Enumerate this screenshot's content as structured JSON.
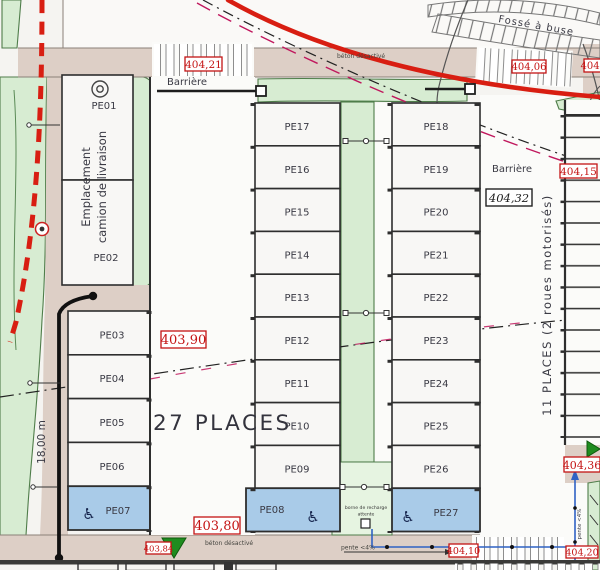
{
  "labels": {
    "places_27": "27 PLACES",
    "places_11": "11 PLACES (2 roues motorisés)",
    "barriere_left": "Barrière",
    "barriere_right": "Barrière",
    "emplacement_l1": "Emplacement",
    "emplacement_l2": "camion de livraison",
    "fosse": "Fossé à buse",
    "beton_top": "béton désactivé",
    "beton_bottom": "béton désactivé",
    "pente_bottom": "pente <4%",
    "pente_right": "pente <4%",
    "dim_left": "18,00 m",
    "borne_l1": "borne de recharge",
    "borne_l2": "attente"
  },
  "levels": {
    "crosswalk_top_left": "404,21",
    "crosswalk_top_right": "404,06",
    "top_right_edge": "404,41",
    "right_edge": "404,15",
    "platform_mid": "404,32",
    "aisle_upper": "403,90",
    "aisle_lower": "403,80",
    "bottom_left": "403,84",
    "bottom_pente": "404,10",
    "bottom_right": "404,20",
    "right_lower": "404,36"
  },
  "stalls": {
    "left_top": [
      "PE01",
      "PE02"
    ],
    "left": [
      "PE03",
      "PE04",
      "PE05",
      "PE06",
      "PE07"
    ],
    "mid_left": [
      "PE17",
      "PE16",
      "PE15",
      "PE14",
      "PE13",
      "PE12",
      "PE11",
      "PE10",
      "PE09",
      "PE08"
    ],
    "mid_right": [
      "PE18",
      "PE19",
      "PE20",
      "PE21",
      "PE22",
      "PE23",
      "PE24",
      "PE25",
      "PE26",
      "PE27"
    ]
  },
  "icons": {
    "accessible": "♿"
  },
  "colors": {
    "road": "#ddcfc6",
    "green": "#d7ecd2",
    "green_pale": "#e6f4e1",
    "stall_blue": "#a9cbe8",
    "red_line": "#d81e12",
    "label_red": "#c41414",
    "magenta": "#c0175d",
    "conduit_blue": "#2f62c4",
    "marker_green": "#1f8c1f"
  }
}
